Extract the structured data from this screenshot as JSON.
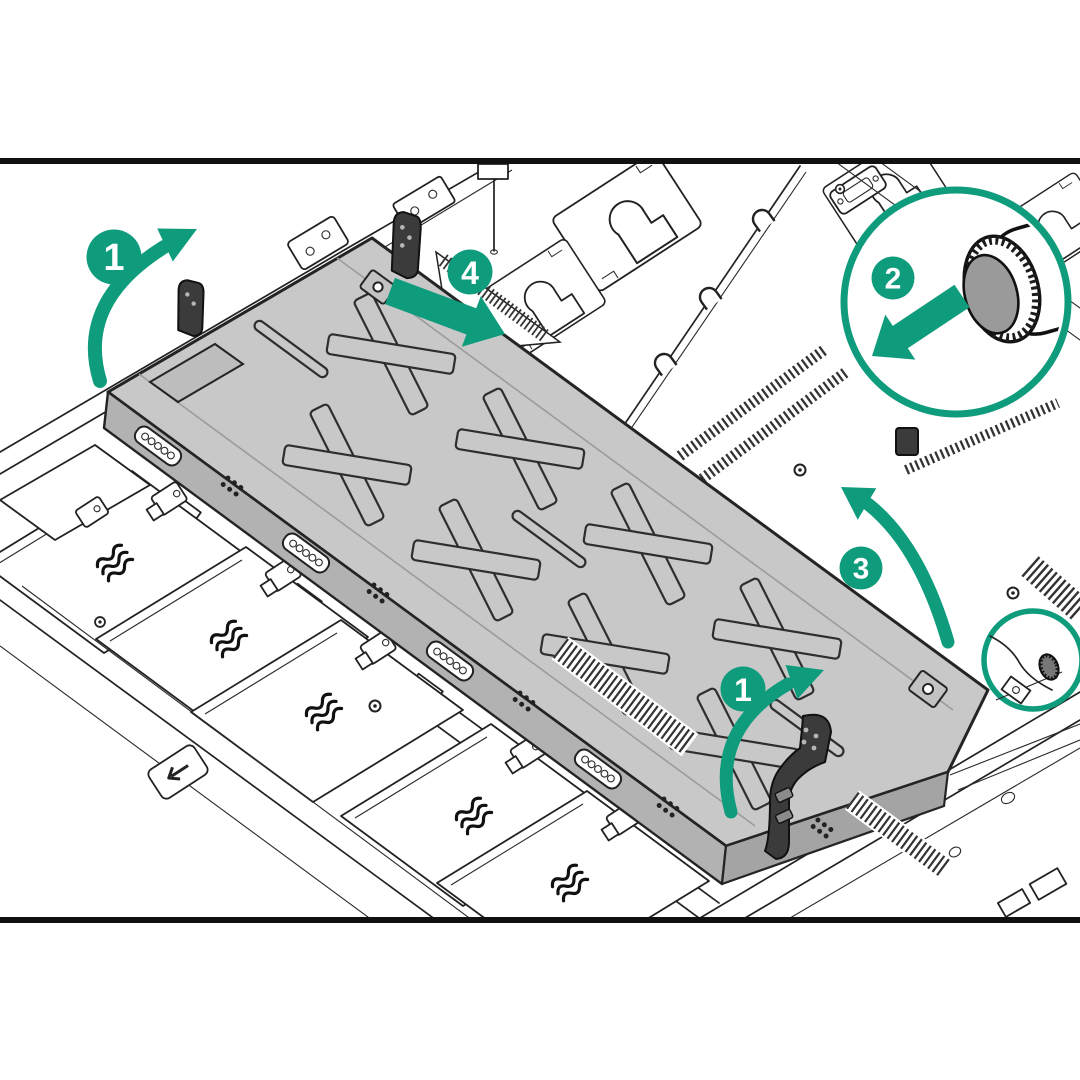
{
  "figure": {
    "type": "hardware-service-illustration",
    "subject": "Removing the air baffle from a rack server chassis",
    "background_color": "#ffffff",
    "accent_color": "#0f9c7d",
    "panel_color": "#c8c8c8",
    "line_color": "#222222",
    "frame": {
      "top_rule": "horizontal black rule near top",
      "bottom_rule": "horizontal black rule near bottom"
    },
    "callouts": [
      {
        "label": "1",
        "position": "top-left",
        "arrow": "curved sweeping up-right"
      },
      {
        "label": "4",
        "position": "top-center",
        "arrow": "straight pointing down-right"
      },
      {
        "label": "2",
        "position": "inside magnifier circle top-right",
        "arrow": "straight pointing down-left",
        "detail": "thumbscrew"
      },
      {
        "label": "3",
        "position": "middle-right",
        "arrow": "curved sweeping up-left"
      },
      {
        "label": "1",
        "position": "bottom-center",
        "arrow": "curved sweeping up-right"
      }
    ],
    "magnifier": {
      "content": "knurled-thumbscrew",
      "shape": "large-circle-outline"
    },
    "highlight": {
      "content": "chassis-thumbscrew-location",
      "shape": "small-circle-outline"
    },
    "icons": {
      "airflow_wave_icon": "three wavy lines on each fan tray",
      "unlock_arrow_plate": "small plate with left arrow on chassis floor"
    }
  }
}
